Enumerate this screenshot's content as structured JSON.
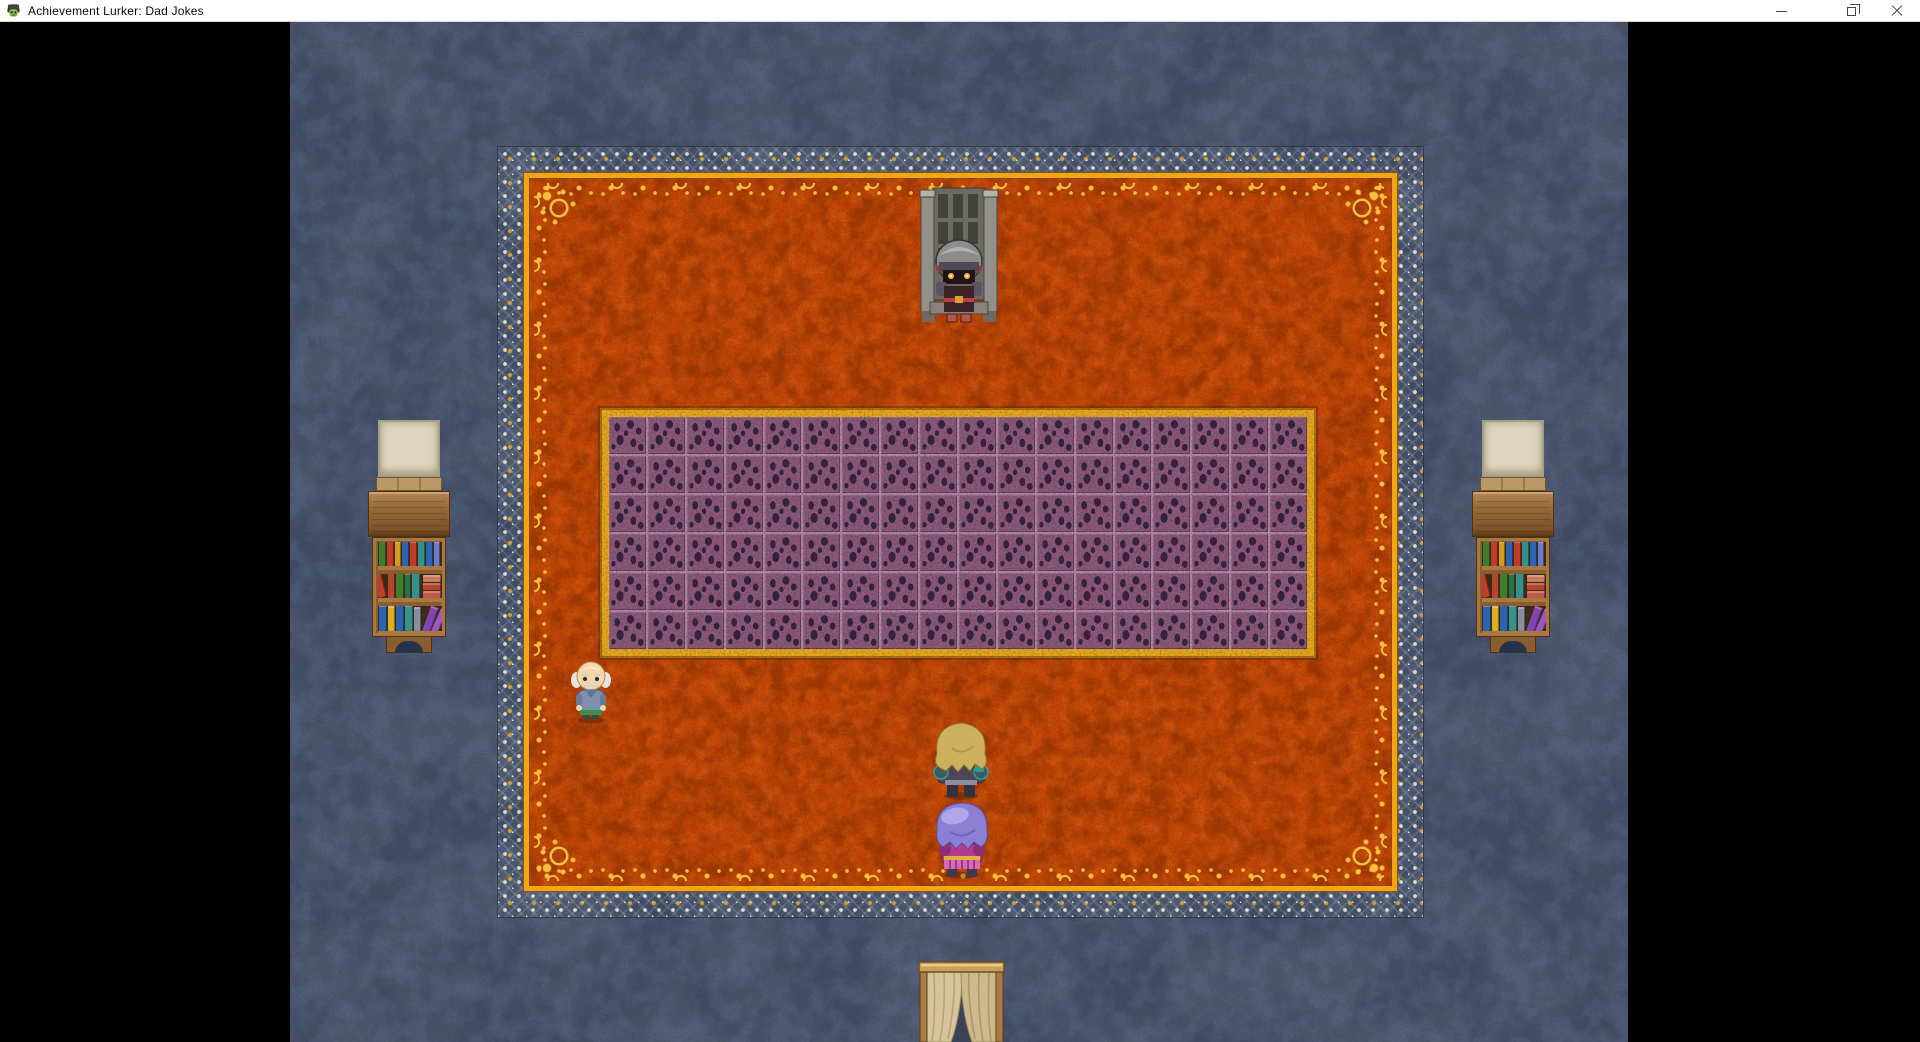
{
  "window": {
    "title": "Achievement Lurker: Dad Jokes",
    "controls": [
      "minimize",
      "restore",
      "close"
    ]
  },
  "theme": {
    "titlebar_bg": "#ffffff",
    "titlebar_fg": "#0a0a0a",
    "control_glyph": "#454545",
    "pillarbox": "#000000",
    "bg": "#4d586e",
    "carpet": "#c14708",
    "gold": "#f2a617",
    "gold_bright": "#ffc83e",
    "silver": "#dcdbd2",
    "border_gold": "#cfa12c",
    "tile": "#8a5a78",
    "tile_spot": "#372340",
    "grout": "#b286a6",
    "tile_frame": "#e8a81c",
    "parchment": "#ddd6bd"
  },
  "sprites": {
    "throne": "stone-throne-with-dark-knight",
    "old_man": "bald-old-man-npc",
    "hero": "blonde-hero-back-view",
    "follower": "purple-haired-follower-back-view",
    "bookshelf": "bookshelf-with-blank-canvas",
    "door": "curtained-doorway",
    "tiles": "purple-stone-tile-platform",
    "carpet": "ornate-orange-carpet"
  },
  "game": {
    "room": {
      "tile_platform": {
        "rows": 6,
        "cols": 18
      },
      "bookshelf": {
        "shelves": [
          [
            {
              "c": "#3f7d2e",
              "w": 8,
              "h": 26
            },
            {
              "c": "#c13a2a",
              "w": 8,
              "h": 27
            },
            {
              "c": "#d99a20",
              "w": 7,
              "h": 25
            },
            {
              "c": "#2e62b5",
              "w": 8,
              "h": 27
            },
            {
              "c": "#c13a2a",
              "w": 7,
              "h": 25
            },
            {
              "c": "#35928a",
              "w": 8,
              "h": 26
            },
            {
              "c": "#2e62b5",
              "w": 8,
              "h": 27
            },
            {
              "c": "#6a7ec0",
              "w": 7,
              "h": 25
            }
          ],
          [
            {
              "c": "#c13a2a",
              "w": 8,
              "h": 26,
              "lean": -14
            },
            {
              "c": "#b5452e",
              "w": 8,
              "h": 26
            },
            {
              "c": "#3f7d2e",
              "w": 8,
              "h": 27
            },
            {
              "c": "#2f6e46",
              "w": 7,
              "h": 25
            },
            {
              "c": "#35928a",
              "w": 8,
              "h": 26
            },
            {
              "c": "#c15a4a",
              "w": 18,
              "h": 7,
              "lying": true
            },
            {
              "c": "#b5452e",
              "w": 18,
              "h": 7,
              "lying": true
            },
            {
              "c": "#c97a5a",
              "w": 18,
              "h": 7,
              "lying": true
            }
          ],
          [
            {
              "c": "#2e62b5",
              "w": 8,
              "h": 26
            },
            {
              "c": "#d9b020",
              "w": 7,
              "h": 25
            },
            {
              "c": "#2e62b5",
              "w": 8,
              "h": 27
            },
            {
              "c": "#35928a",
              "w": 8,
              "h": 26
            },
            {
              "c": "#888f9a",
              "w": 7,
              "h": 24
            },
            {
              "c": "#8246b0",
              "w": 8,
              "h": 27,
              "lean": 20
            },
            {
              "c": "#9a58c0",
              "w": 7,
              "h": 25,
              "lean": 24
            }
          ]
        ]
      }
    }
  }
}
